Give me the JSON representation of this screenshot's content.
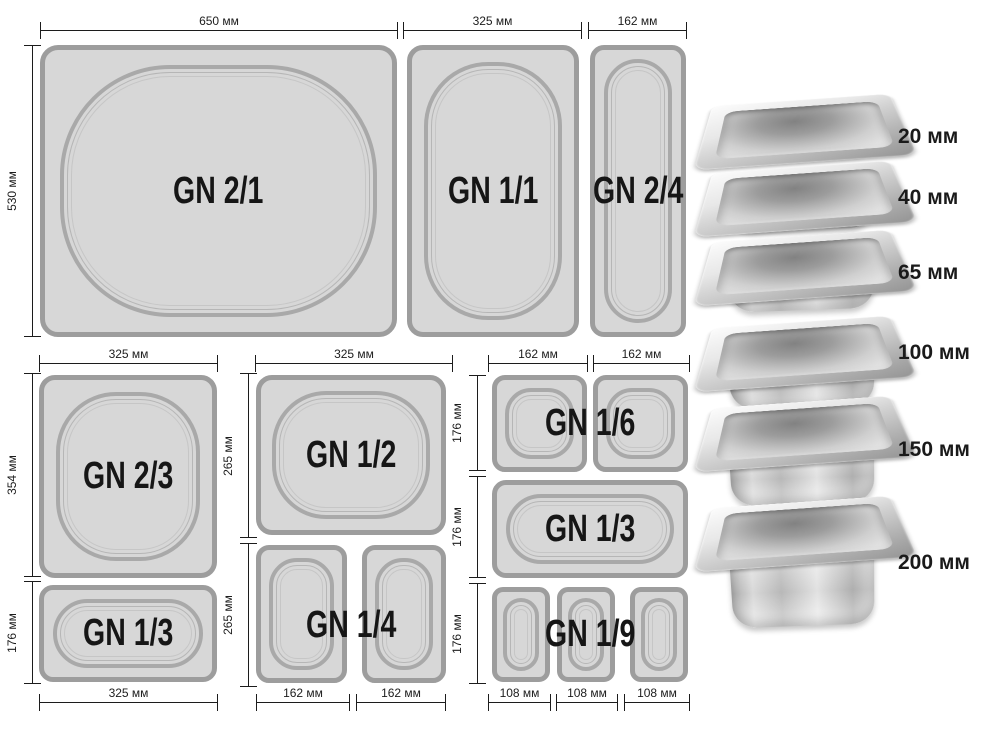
{
  "diagram": {
    "row1": {
      "dims_top": [
        "650 мм",
        "325 мм",
        "162 мм"
      ],
      "dim_left": "530 мм",
      "pans": [
        "GN 2/1",
        "GN 1/1",
        "GN 2/4"
      ]
    },
    "groupA": {
      "dim_top": "325 мм",
      "dims_left": [
        "354 мм",
        "176 мм"
      ],
      "dim_bottom": "325 мм",
      "pans": [
        "GN 2/3",
        "GN 1/3"
      ]
    },
    "groupB": {
      "dim_top": "325 мм",
      "dims_left": [
        "265 мм",
        "265 мм"
      ],
      "dims_bottom": [
        "162 мм",
        "162 мм"
      ],
      "pans": [
        "GN 1/2",
        "GN 1/4"
      ]
    },
    "groupC": {
      "dims_top": [
        "162 мм",
        "162 мм"
      ],
      "dims_left": [
        "176 мм",
        "176 мм",
        "176 мм"
      ],
      "dims_bottom": [
        "108 мм",
        "108 мм",
        "108 мм"
      ],
      "pans": [
        "GN 1/6",
        "GN 1/3",
        "GN 1/9"
      ]
    },
    "depth_labels": [
      "20 мм",
      "40 мм",
      "65 мм",
      "100 мм",
      "150 мм",
      "200 мм"
    ]
  },
  "colors": {
    "pan_fill": "#d7d7d7",
    "pan_border": "#9d9d9d",
    "well_ring": "#a9a9a9",
    "dim_line": "#1c1c1c",
    "label_text": "#161616"
  }
}
